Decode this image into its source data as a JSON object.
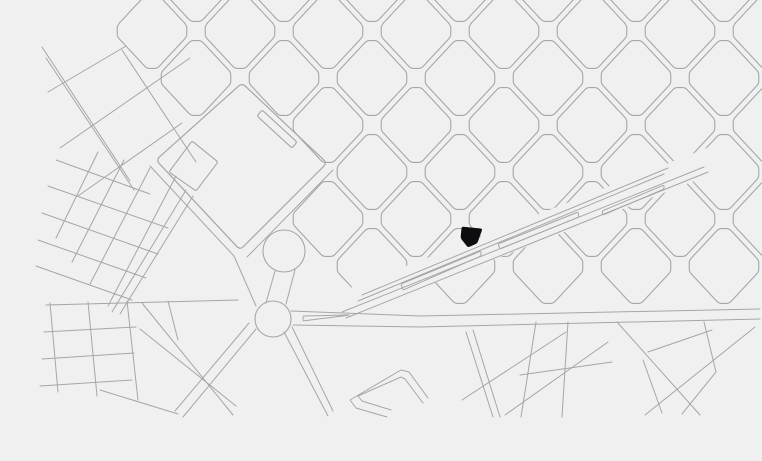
{
  "map": {
    "description": "city-plan-figure-ground-map-with-highlighted-site",
    "canvas": {
      "width": 762,
      "height": 461
    },
    "colors": {
      "background": "#f0f0f1",
      "street_line": "#a6a6a9",
      "street_line_soft": "#b3b3b6",
      "site_fill": "#0d0d0f"
    },
    "grid": {
      "origin": [
        372,
        78
      ],
      "step_se": [
        44,
        47
      ],
      "step_ne": [
        44,
        -47
      ],
      "block_half_w": 40,
      "block_half_h": 43,
      "chamfer": 0.13,
      "corner_radius": 3,
      "cells": [
        [
          -4,
          -2
        ],
        [
          -2,
          -2
        ],
        [
          0,
          -2
        ],
        [
          2,
          -2
        ],
        [
          4,
          -2
        ],
        [
          6,
          -2
        ],
        [
          8,
          -2
        ],
        [
          -5,
          -1
        ],
        [
          -3,
          -1
        ],
        [
          -1,
          -1
        ],
        [
          1,
          -1
        ],
        [
          3,
          -1
        ],
        [
          5,
          -1
        ],
        [
          7,
          -1
        ],
        [
          9,
          -1
        ],
        [
          -4,
          0
        ],
        [
          -2,
          0
        ],
        [
          0,
          0
        ],
        [
          2,
          0
        ],
        [
          4,
          0
        ],
        [
          6,
          0
        ],
        [
          8,
          0
        ],
        [
          -1,
          1
        ],
        [
          1,
          1
        ],
        [
          3,
          1
        ],
        [
          5,
          1
        ],
        [
          7,
          1
        ],
        [
          9,
          1
        ],
        [
          0,
          2
        ],
        [
          2,
          2
        ],
        [
          4,
          2
        ],
        [
          6,
          2
        ],
        [
          8,
          2
        ],
        [
          -1,
          3
        ],
        [
          1,
          3
        ],
        [
          3,
          3
        ],
        [
          5,
          3
        ],
        [
          7,
          3
        ],
        [
          9,
          3
        ],
        [
          0,
          4
        ],
        [
          2,
          4
        ],
        [
          4,
          4
        ],
        [
          6,
          4
        ],
        [
          8,
          4
        ]
      ]
    },
    "park": {
      "outline": [
        [
          242,
          83
        ],
        [
          327,
          163
        ],
        [
          240,
          250
        ],
        [
          156,
          160
        ]
      ],
      "inner_block": [
        [
          192,
          141
        ],
        [
          218,
          162
        ],
        [
          196,
          191
        ],
        [
          169,
          172
        ]
      ],
      "inner_bar": [
        [
          262,
          110
        ],
        [
          297,
          142
        ],
        [
          292,
          148
        ],
        [
          257,
          116
        ]
      ]
    },
    "plaza_circle": {
      "cx": 284,
      "cy": 251,
      "r": 21
    },
    "roundabout": {
      "cx": 273,
      "cy": 319,
      "r": 18
    },
    "site_marker": {
      "polygon": [
        [
          462,
          227
        ],
        [
          482,
          229
        ],
        [
          477,
          243
        ],
        [
          468,
          247
        ],
        [
          461,
          238
        ]
      ]
    },
    "avenue": {
      "cut_band": [
        [
          340,
          292
        ],
        [
          712,
          146
        ],
        [
          712,
          174
        ],
        [
          340,
          320
        ]
      ],
      "lines": [
        [
          [
            346,
            318
          ],
          [
            708,
            172
          ]
        ],
        [
          [
            342,
            312
          ],
          [
            704,
            167
          ]
        ],
        [
          [
            358,
            301
          ],
          [
            664,
            174
          ]
        ],
        [
          [
            362,
            295
          ],
          [
            668,
            168
          ]
        ]
      ],
      "medians": [
        [
          [
            401,
            284
          ],
          [
            481,
            251
          ],
          [
            481,
            256
          ],
          [
            403,
            290
          ]
        ],
        [
          [
            498,
            244
          ],
          [
            578,
            212
          ],
          [
            579,
            217
          ],
          [
            500,
            249
          ]
        ],
        [
          [
            602,
            211
          ],
          [
            664,
            185
          ],
          [
            664,
            189
          ],
          [
            603,
            215
          ]
        ]
      ]
    },
    "main_street": {
      "upper_edge": [
        [
          291,
          311
        ],
        [
          420,
          316
        ],
        [
          760,
          309
        ]
      ],
      "lower_edge": [
        [
          293,
          325
        ],
        [
          420,
          327
        ],
        [
          760,
          319
        ]
      ],
      "median": [
        [
          303,
          321
        ],
        [
          350,
          315
        ],
        [
          303,
          316
        ]
      ]
    },
    "streets": [
      [
        [
          42,
          47
        ],
        [
          130,
          181
        ]
      ],
      [
        [
          46,
          58
        ],
        [
          134,
          190
        ]
      ],
      [
        [
          122,
          50
        ],
        [
          196,
          162
        ]
      ],
      [
        [
          48,
          92
        ],
        [
          126,
          46
        ]
      ],
      [
        [
          60,
          148
        ],
        [
          190,
          58
        ]
      ],
      [
        [
          78,
          196
        ],
        [
          182,
          123
        ]
      ],
      [
        [
          56,
          160
        ],
        [
          150,
          194
        ]
      ],
      [
        [
          48,
          186
        ],
        [
          168,
          228
        ]
      ],
      [
        [
          42,
          213
        ],
        [
          158,
          254
        ]
      ],
      [
        [
          38,
          240
        ],
        [
          146,
          278
        ]
      ],
      [
        [
          36,
          266
        ],
        [
          132,
          300
        ]
      ],
      [
        [
          98,
          152
        ],
        [
          56,
          238
        ]
      ],
      [
        [
          124,
          160
        ],
        [
          72,
          262
        ]
      ],
      [
        [
          150,
          168
        ],
        [
          90,
          284
        ]
      ],
      [
        [
          176,
          176
        ],
        [
          108,
          306
        ]
      ],
      [
        [
          186,
          190
        ],
        [
          112,
          312
        ]
      ],
      [
        [
          193,
          196
        ],
        [
          120,
          314
        ]
      ],
      [
        [
          150,
          166
        ],
        [
          234,
          256
        ],
        [
          256,
          306
        ]
      ],
      [
        [
          333,
          170
        ],
        [
          247,
          257
        ]
      ],
      [
        [
          275,
          271
        ],
        [
          266,
          303
        ]
      ],
      [
        [
          295,
          270
        ],
        [
          286,
          304
        ]
      ],
      [
        [
          284,
          332
        ],
        [
          328,
          416
        ]
      ],
      [
        [
          292,
          327
        ],
        [
          333,
          411
        ]
      ],
      [
        [
          256,
          329
        ],
        [
          183,
          417
        ]
      ],
      [
        [
          249,
          323
        ],
        [
          175,
          411
        ]
      ],
      [
        [
          46,
          305
        ],
        [
          238,
          300
        ]
      ],
      [
        [
          44,
          332
        ],
        [
          136,
          327
        ]
      ],
      [
        [
          42,
          359
        ],
        [
          134,
          353
        ]
      ],
      [
        [
          40,
          386
        ],
        [
          132,
          380
        ]
      ],
      [
        [
          50,
          303
        ],
        [
          58,
          392
        ]
      ],
      [
        [
          88,
          302
        ],
        [
          97,
          396
        ]
      ],
      [
        [
          127,
          301
        ],
        [
          138,
          400
        ]
      ],
      [
        [
          140,
          329
        ],
        [
          236,
          406
        ]
      ],
      [
        [
          142,
          303
        ],
        [
          233,
          415
        ]
      ],
      [
        [
          100,
          390
        ],
        [
          178,
          414
        ]
      ],
      [
        [
          168,
          301
        ],
        [
          178,
          340
        ]
      ],
      [
        [
          466,
          332
        ],
        [
          493,
          417
        ]
      ],
      [
        [
          473,
          330
        ],
        [
          500,
          417
        ]
      ],
      [
        [
          536,
          322
        ],
        [
          521,
          417
        ]
      ],
      [
        [
          568,
          322
        ],
        [
          562,
          417
        ]
      ],
      [
        [
          617,
          322
        ],
        [
          700,
          415
        ]
      ],
      [
        [
          755,
          327
        ],
        [
          645,
          415
        ]
      ],
      [
        [
          462,
          400
        ],
        [
          566,
          332
        ]
      ],
      [
        [
          505,
          415
        ],
        [
          608,
          342
        ]
      ],
      [
        [
          520,
          375
        ],
        [
          612,
          362
        ]
      ],
      [
        [
          648,
          352
        ],
        [
          712,
          330
        ]
      ],
      [
        [
          704,
          322
        ],
        [
          716,
          372
        ]
      ],
      [
        [
          716,
          372
        ],
        [
          682,
          414
        ]
      ],
      [
        [
          643,
          360
        ],
        [
          662,
          413
        ]
      ]
    ],
    "u_building": {
      "outer": [
        [
          387,
          417
        ],
        [
          356,
          408
        ],
        [
          350,
          400
        ],
        [
          401,
          370
        ],
        [
          409,
          372
        ],
        [
          428,
          398
        ]
      ],
      "inner": [
        [
          391,
          410
        ],
        [
          362,
          401
        ],
        [
          358,
          396
        ],
        [
          401,
          377
        ],
        [
          405,
          379
        ],
        [
          423,
          403
        ]
      ]
    }
  }
}
